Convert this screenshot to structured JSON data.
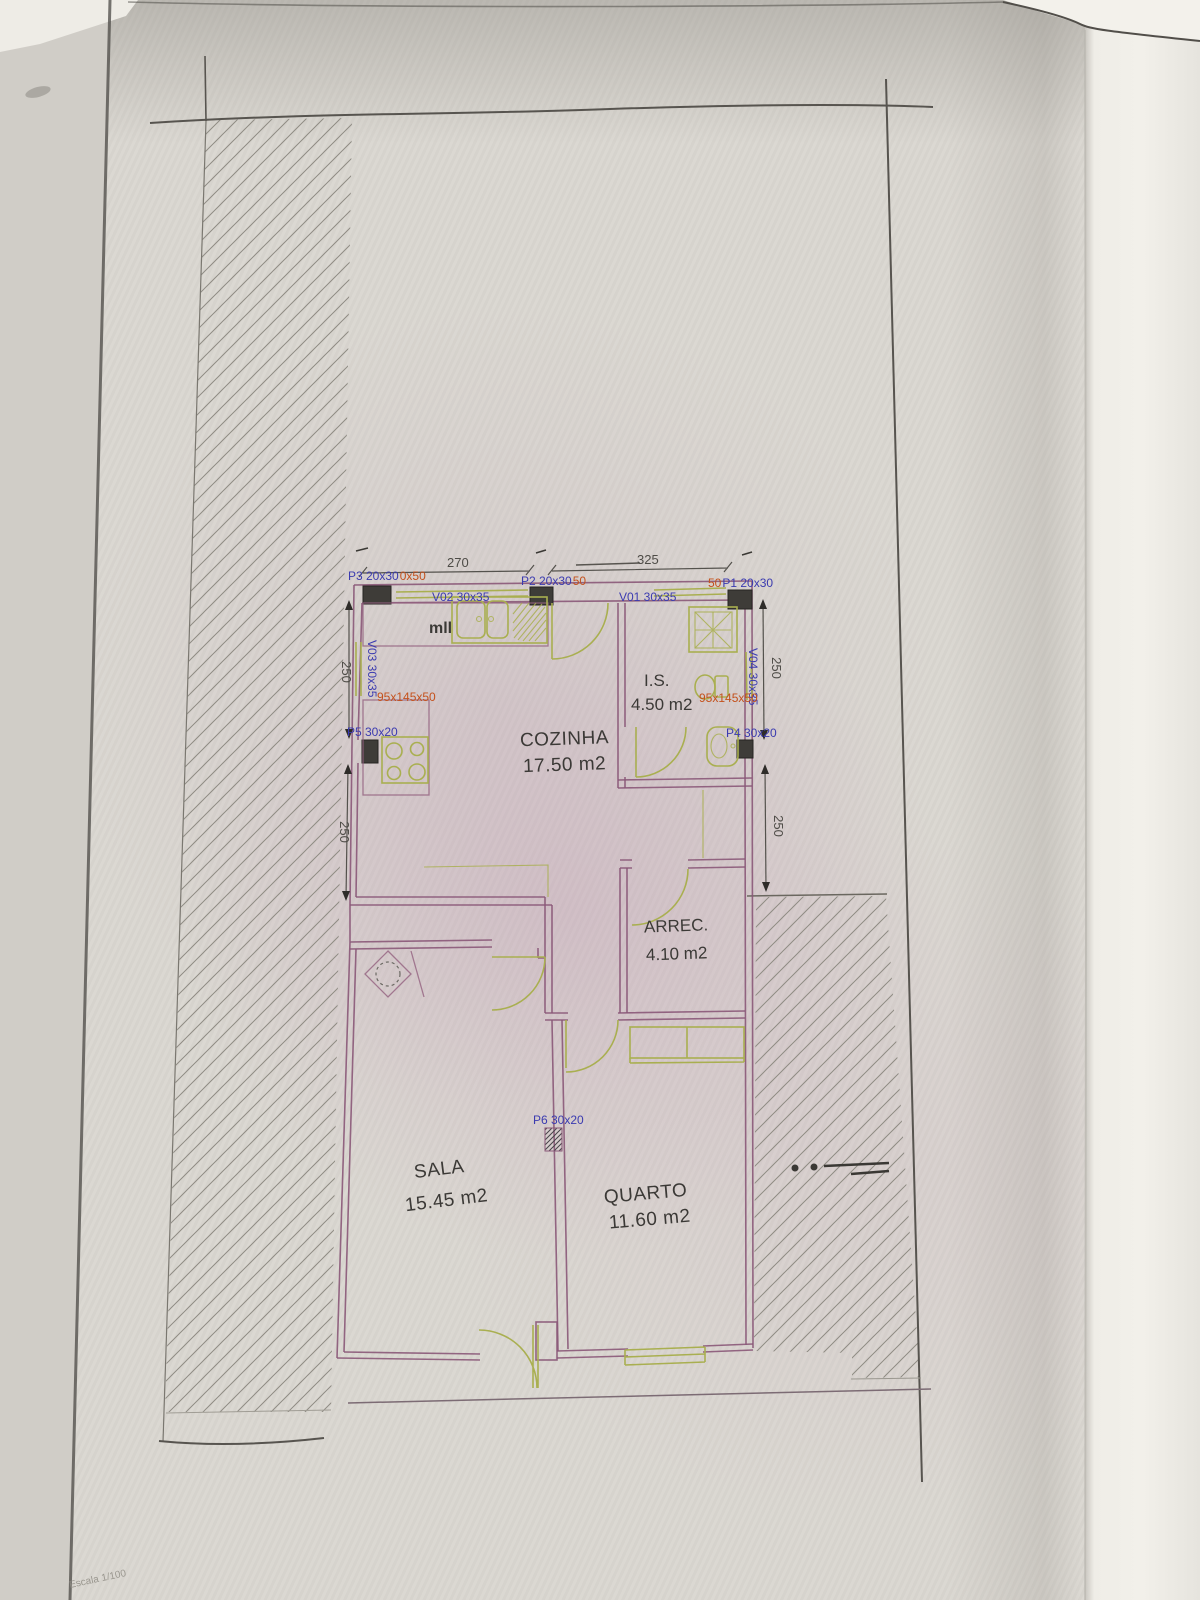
{
  "plan": {
    "rooms": [
      {
        "name": "COZINHA",
        "area": "17.50 m2"
      },
      {
        "name": "I.S.",
        "area": "4.50 m2"
      },
      {
        "name": "ARREC.",
        "area": "4.10 m2"
      },
      {
        "name": "SALA",
        "area": "15.45 m2"
      },
      {
        "name": "QUARTO",
        "area": "11.60 m2"
      }
    ],
    "pillars": {
      "p1": "P1 20x30",
      "p1_extra": "50",
      "p2": "P2 20x30",
      "p2_extra": "50",
      "p3": "P3 20x30",
      "p3_extra": "0x50",
      "p4": "P4 30x20",
      "p5": "P5 30x20",
      "p6": "P6 30x20"
    },
    "windows": {
      "v01": "V01 30x35",
      "v02": "V02 30x35",
      "v03": "V03 30x35",
      "v04": "V04 30x35"
    },
    "counters": {
      "left": "95x145x50",
      "right": "95x145x50"
    },
    "notes": {
      "mll": "mll",
      "scale": "Escala 1/100"
    },
    "dimensions": {
      "top_left": "270",
      "top_right": "325",
      "left_upper": "250",
      "left_lower": "250",
      "right_upper": "250",
      "right_lower": "250"
    }
  },
  "colors": {
    "wall": "#8a5878",
    "fixture": "#a9af50",
    "label_blue": "#3b3bb0",
    "label_orange": "#c4511c",
    "pillar_fill": "#3e3c38",
    "boundary": "#57544f",
    "paper": "#d9d6d0"
  }
}
